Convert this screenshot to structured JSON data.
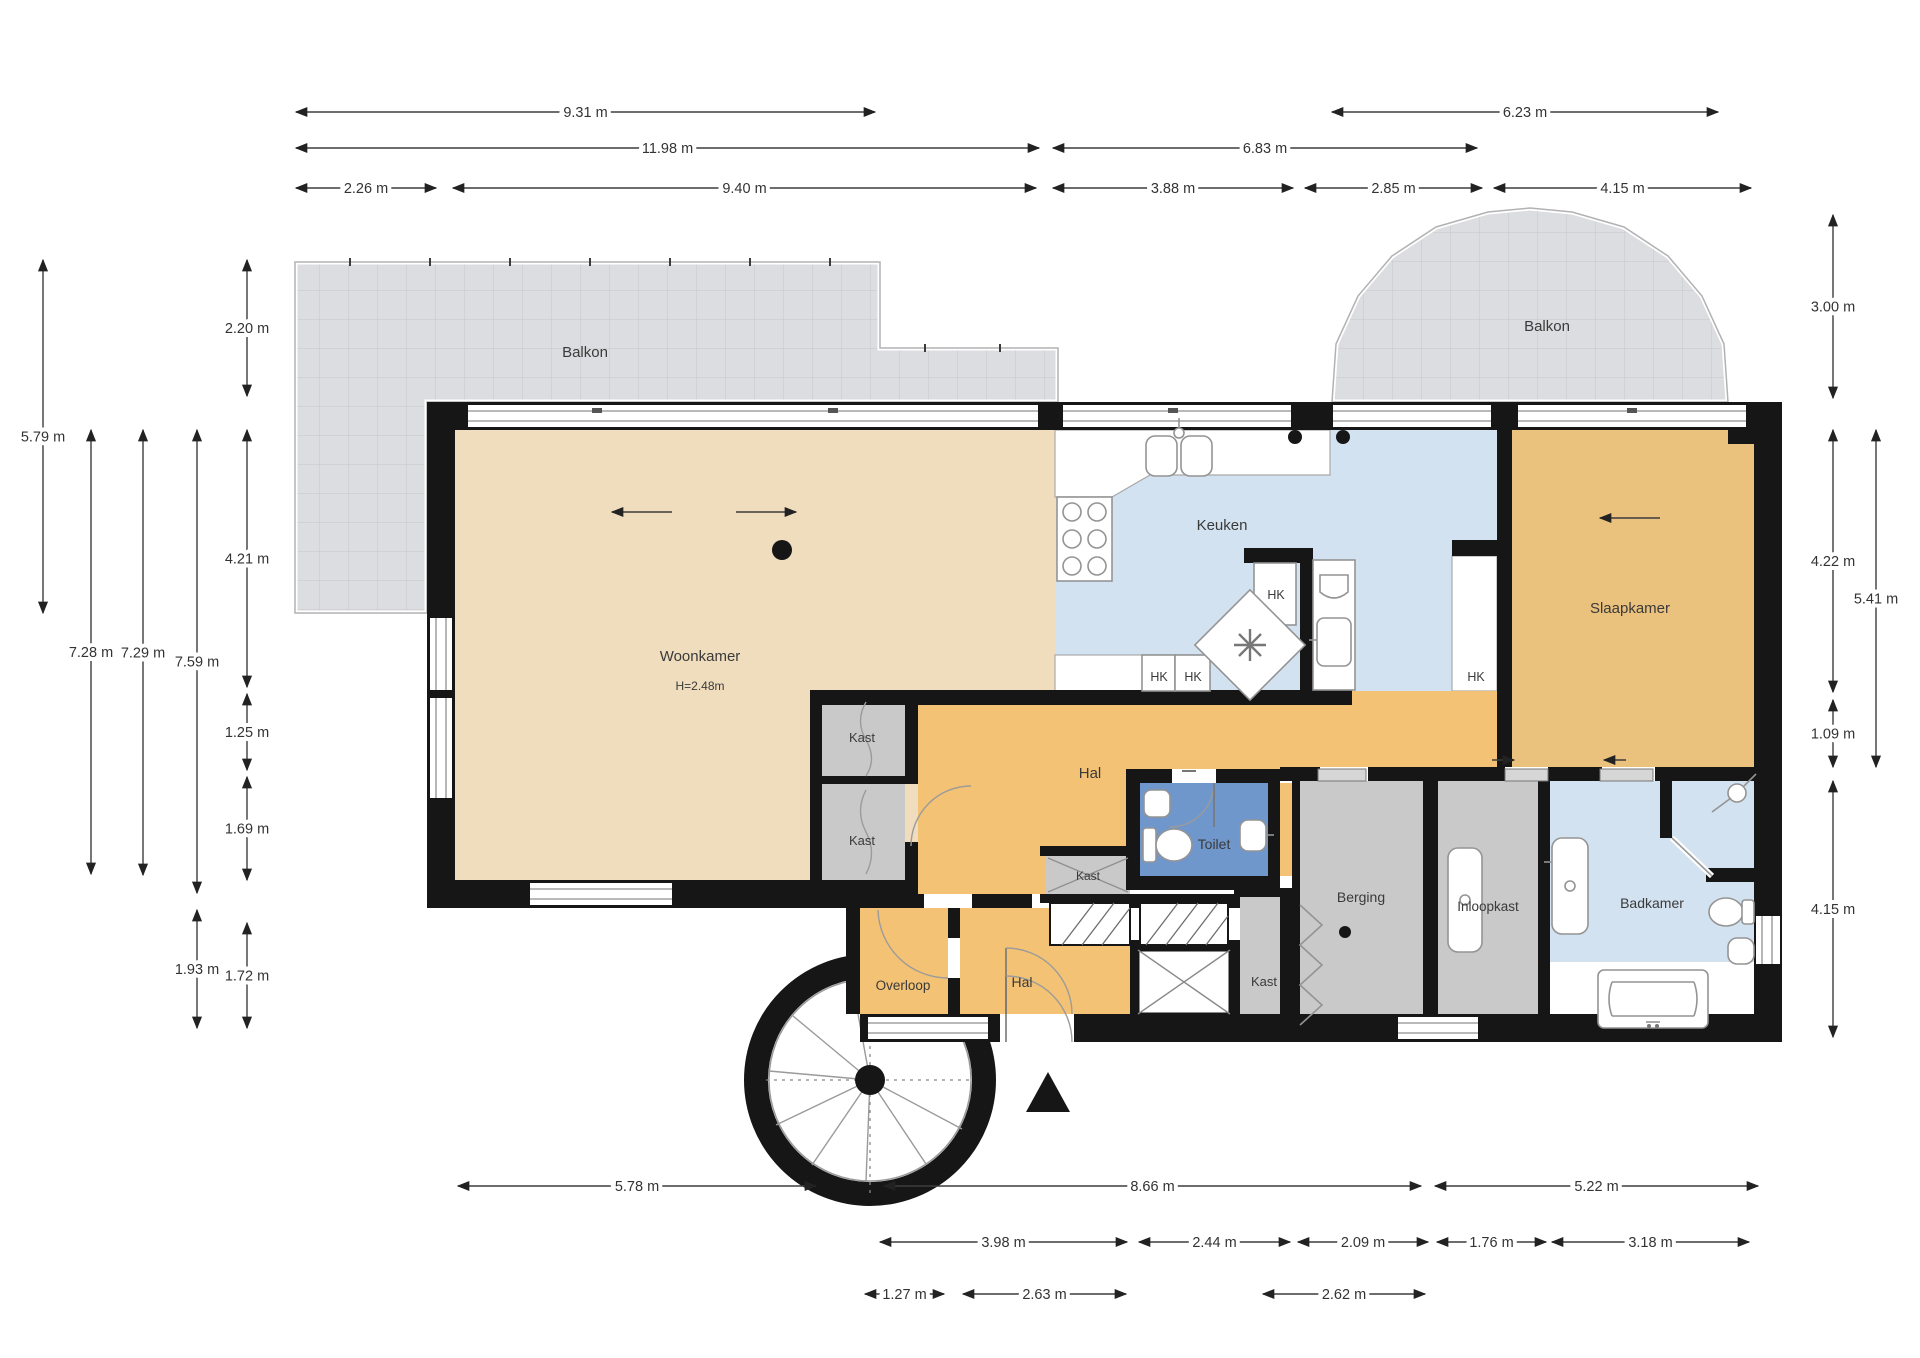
{
  "plan": {
    "room_labels": [
      {
        "name": "balkon-left",
        "text": "Balkon",
        "x": 585,
        "y": 357,
        "size": 15
      },
      {
        "name": "balkon-right",
        "text": "Balkon",
        "x": 1547,
        "y": 331,
        "size": 15
      },
      {
        "name": "woonkamer",
        "text": "Woonkamer",
        "x": 700,
        "y": 661,
        "size": 15
      },
      {
        "name": "woonkamer-height",
        "text": "H=2.48m",
        "x": 700,
        "y": 690,
        "size": 12
      },
      {
        "name": "keuken",
        "text": "Keuken",
        "x": 1222,
        "y": 530,
        "size": 15
      },
      {
        "name": "slaapkamer",
        "text": "Slaapkamer",
        "x": 1630,
        "y": 613,
        "size": 15
      },
      {
        "name": "hal-upper",
        "text": "Hal",
        "x": 1090,
        "y": 778,
        "size": 15
      },
      {
        "name": "toilet",
        "text": "Toilet",
        "x": 1214,
        "y": 849,
        "size": 14
      },
      {
        "name": "kast-1",
        "text": "Kast",
        "x": 862,
        "y": 742,
        "size": 13
      },
      {
        "name": "kast-2",
        "text": "Kast",
        "x": 862,
        "y": 845,
        "size": 13
      },
      {
        "name": "kast-small",
        "text": "Kast",
        "x": 1088,
        "y": 880,
        "size": 12
      },
      {
        "name": "overloop",
        "text": "Overloop",
        "x": 903,
        "y": 990,
        "size": 13.5
      },
      {
        "name": "hal-lower",
        "text": "Hal",
        "x": 1022,
        "y": 987,
        "size": 14
      },
      {
        "name": "kast-right",
        "text": "Kast",
        "x": 1264,
        "y": 986,
        "size": 13
      },
      {
        "name": "berging",
        "text": "Berging",
        "x": 1361,
        "y": 902,
        "size": 14
      },
      {
        "name": "inloopkast",
        "text": "Inloopkast",
        "x": 1488,
        "y": 911,
        "size": 13.5
      },
      {
        "name": "badkamer",
        "text": "Badkamer",
        "x": 1652,
        "y": 908,
        "size": 14
      }
    ],
    "hk_text": "HK",
    "hk_labels": [
      {
        "x": 1276,
        "y": 599
      },
      {
        "x": 1159,
        "y": 681
      },
      {
        "x": 1193,
        "y": 681
      },
      {
        "x": 1476,
        "y": 681
      }
    ],
    "dimensions": {
      "horizontal": [
        {
          "label": "9.31 m",
          "x1": 296,
          "x2": 875,
          "y": 112
        },
        {
          "label": "6.23 m",
          "x1": 1332,
          "x2": 1718,
          "y": 112
        },
        {
          "label": "11.98 m",
          "x1": 296,
          "x2": 1039,
          "y": 148
        },
        {
          "label": "6.83 m",
          "x1": 1053,
          "x2": 1477,
          "y": 148
        },
        {
          "label": "2.26 m",
          "x1": 296,
          "x2": 436,
          "y": 188
        },
        {
          "label": "9.40 m",
          "x1": 453,
          "x2": 1036,
          "y": 188
        },
        {
          "label": "3.88 m",
          "x1": 1053,
          "x2": 1293,
          "y": 188
        },
        {
          "label": "2.85 m",
          "x1": 1305,
          "x2": 1482,
          "y": 188
        },
        {
          "label": "4.15 m",
          "x1": 1494,
          "x2": 1751,
          "y": 188
        },
        {
          "label": "5.78 m",
          "x1": 458,
          "x2": 816,
          "y": 1186
        },
        {
          "label": "8.66 m",
          "x1": 884,
          "x2": 1421,
          "y": 1186
        },
        {
          "label": "5.22 m",
          "x1": 1435,
          "x2": 1758,
          "y": 1186
        },
        {
          "label": "3.98 m",
          "x1": 880,
          "x2": 1127,
          "y": 1242
        },
        {
          "label": "2.44 m",
          "x1": 1139,
          "x2": 1290,
          "y": 1242
        },
        {
          "label": "2.09 m",
          "x1": 1298,
          "x2": 1428,
          "y": 1242
        },
        {
          "label": "1.76 m",
          "x1": 1437,
          "x2": 1546,
          "y": 1242
        },
        {
          "label": "3.18 m",
          "x1": 1552,
          "x2": 1749,
          "y": 1242
        },
        {
          "label": "1.27 m",
          "x1": 865,
          "x2": 944,
          "y": 1294
        },
        {
          "label": "2.63 m",
          "x1": 963,
          "x2": 1126,
          "y": 1294
        },
        {
          "label": "2.62 m",
          "x1": 1263,
          "x2": 1425,
          "y": 1294
        }
      ],
      "vertical": [
        {
          "label": "5.79 m",
          "x": 43,
          "y1": 260,
          "y2": 613
        },
        {
          "label": "2.20 m",
          "x": 247,
          "y1": 260,
          "y2": 396
        },
        {
          "label": "4.21 m",
          "x": 247,
          "y1": 430,
          "y2": 687
        },
        {
          "label": "1.25 m",
          "x": 247,
          "y1": 694,
          "y2": 770
        },
        {
          "label": "1.69 m",
          "x": 247,
          "y1": 777,
          "y2": 880
        },
        {
          "label": "7.28 m",
          "x": 91,
          "y1": 430,
          "y2": 874
        },
        {
          "label": "7.29 m",
          "x": 143,
          "y1": 430,
          "y2": 875
        },
        {
          "label": "7.59 m",
          "x": 197,
          "y1": 430,
          "y2": 893
        },
        {
          "label": "1.93 m",
          "x": 197,
          "y1": 910,
          "y2": 1028
        },
        {
          "label": "1.72 m",
          "x": 247,
          "y1": 923,
          "y2": 1028
        },
        {
          "label": "3.00 m",
          "x": 1833,
          "y1": 215,
          "y2": 398
        },
        {
          "label": "4.22 m",
          "x": 1833,
          "y1": 430,
          "y2": 692
        },
        {
          "label": "1.09 m",
          "x": 1833,
          "y1": 700,
          "y2": 767
        },
        {
          "label": "4.15 m",
          "x": 1833,
          "y1": 781,
          "y2": 1037
        },
        {
          "label": "5.41 m",
          "x": 1876,
          "y1": 430,
          "y2": 767
        }
      ]
    },
    "colors": {
      "wall": "#161616",
      "woonkamer": "#efddbd",
      "hal": "#f3c274",
      "slaapkamer": "#eac17d",
      "keuken_badkamer": "#d3e2f0",
      "toilet": "#7097cb",
      "closet_gray": "#c9c9c9",
      "balkon": "#dcdde0"
    }
  }
}
